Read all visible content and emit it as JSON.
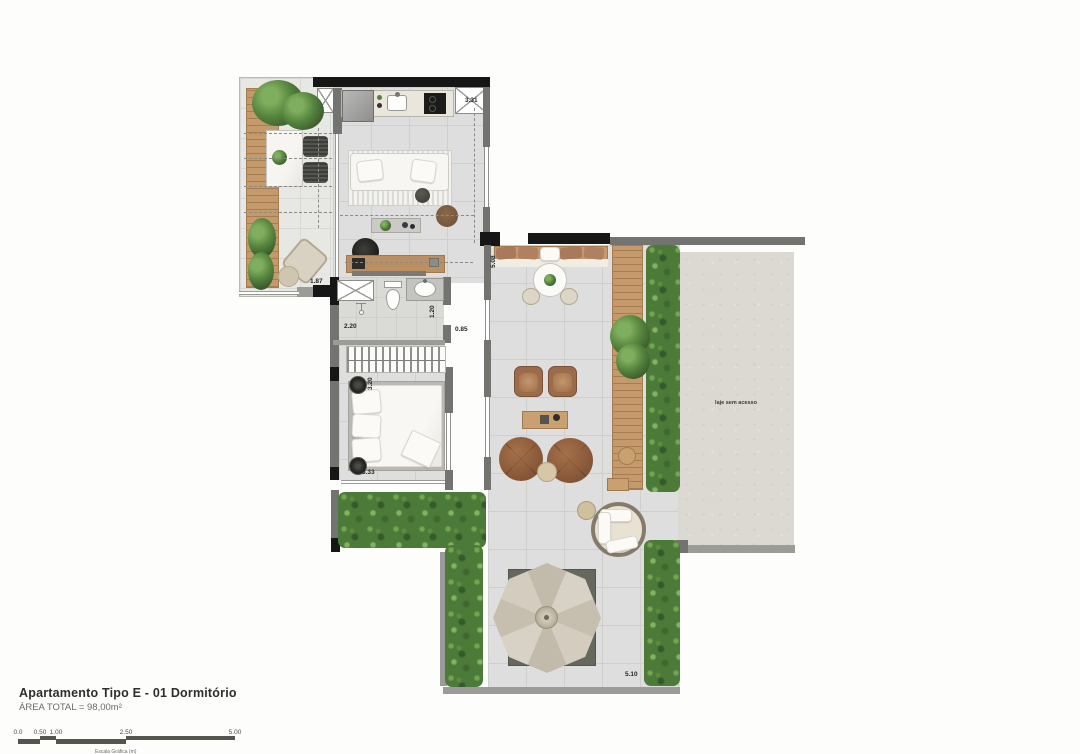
{
  "title_block": {
    "title": "Apartamento Tipo E - 01 Dormitório",
    "area": "ÁREA TOTAL = 98,00m²"
  },
  "scale_bar": {
    "ticks": [
      "0.0",
      "0.50",
      "1.00",
      "2.50",
      "5.00"
    ],
    "caption": "Escala Gráfica (m)"
  },
  "plan": {
    "laje_label": "laje sem acesso",
    "dims": {
      "kitchen_width": "3.31",
      "balcony_width": "1.87",
      "bath_width": "2.20",
      "bath_door": "0.85",
      "bath_depth": "1.20",
      "bed_width": "3.20",
      "bed_length": "3.33",
      "terrace_depth": "5.08",
      "terrace_width": "5.10"
    },
    "colors": {
      "wood": "#c49a6c",
      "plant_green": "#4c7a38",
      "wall_gray": "#737370",
      "wall_black": "#161616",
      "floor_gray": "#dedede",
      "slab_gray": "#dcd8d2",
      "furniture_brown": "#9c6b49"
    }
  }
}
